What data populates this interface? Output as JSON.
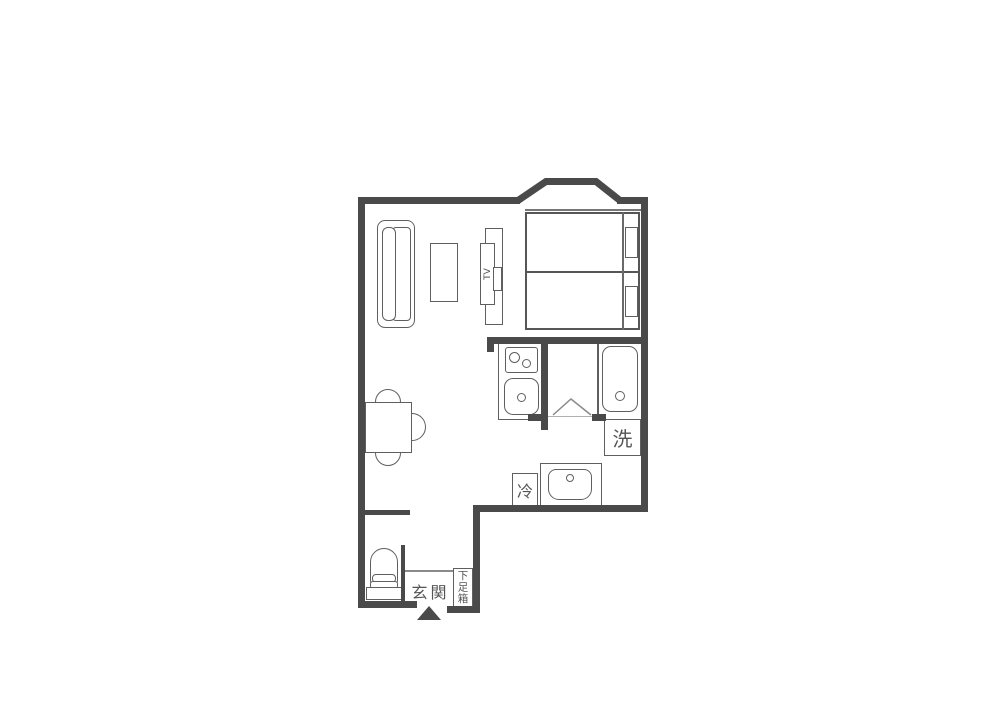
{
  "floor_plan": {
    "kind": "japanese-room-floor-plan",
    "colors": {
      "wall": "#4a4a4a",
      "line": "#5f5f5f",
      "text": "#555555",
      "background": "#ffffff"
    },
    "labels": {
      "tv": "TV",
      "washing_machine": "洗",
      "refrigerator": "冷",
      "entrance": "玄関",
      "shoe_cabinet": "下足箱"
    },
    "fixtures": [
      "bay-window",
      "twin-bed-upper",
      "twin-bed-lower",
      "pillows",
      "sofa",
      "coffee-table",
      "tv-stand",
      "dining-table",
      "chairs",
      "kitchen-stove",
      "kitchen-sink",
      "bathtub",
      "washing-machine-space",
      "washbasin",
      "refrigerator-space",
      "toilet",
      "shoe-cabinet",
      "entrance-arrow",
      "door-swing"
    ]
  }
}
